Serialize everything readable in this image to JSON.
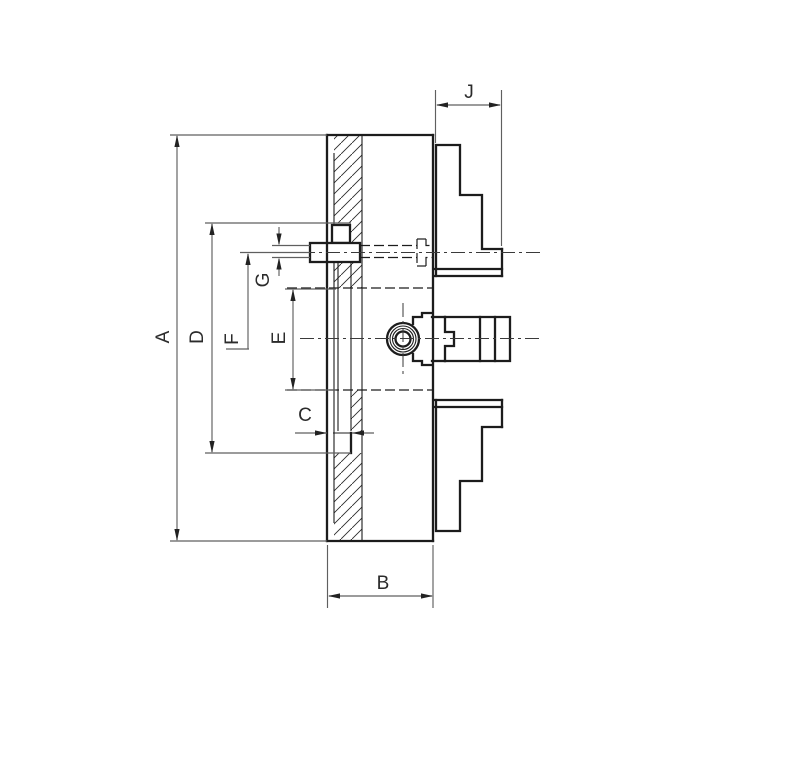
{
  "drawing_labels": {
    "A": "A",
    "B": "B",
    "C": "C",
    "D": "D",
    "E": "E",
    "F": "F",
    "G": "G",
    "J": "J"
  },
  "colors": {
    "background": "#ffffff",
    "outline": "#1c1c1c",
    "dimension": "#5f5f5f",
    "label_text": "#2b2b2b"
  }
}
